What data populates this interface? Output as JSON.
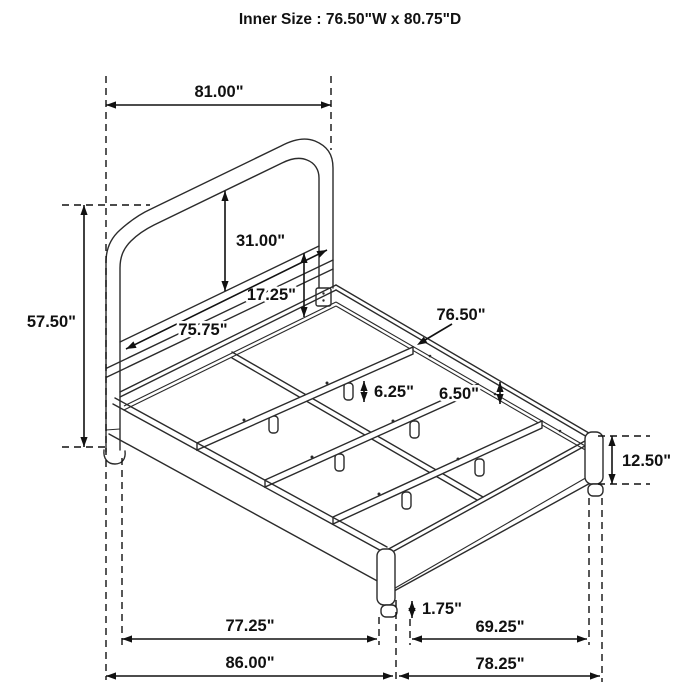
{
  "title": "Inner Size : 76.50\"W x 80.75\"D",
  "drawing": {
    "subject": "bed-frame-dimension-diagram",
    "line_color": "#2b2b2b",
    "dimension_color": "#111111",
    "background": "#ffffff",
    "dimensions": {
      "headboard_width": "81.00\"",
      "headboard_height": "57.50\"",
      "headboard_panel_height": "31.00\"",
      "panel_to_rail": "17.25\"",
      "headboard_inner_width": "75.75\"",
      "slat_width": "76.50\"",
      "side_rail_height": "6.50\"",
      "slat_leg_height": "6.25\"",
      "footboard_height": "12.50\"",
      "foot_height": "1.75\"",
      "frame_inner_width": "77.25\"",
      "side_inner_length": "69.25\"",
      "overall_width": "86.00\"",
      "overall_depth": "78.25\""
    }
  }
}
